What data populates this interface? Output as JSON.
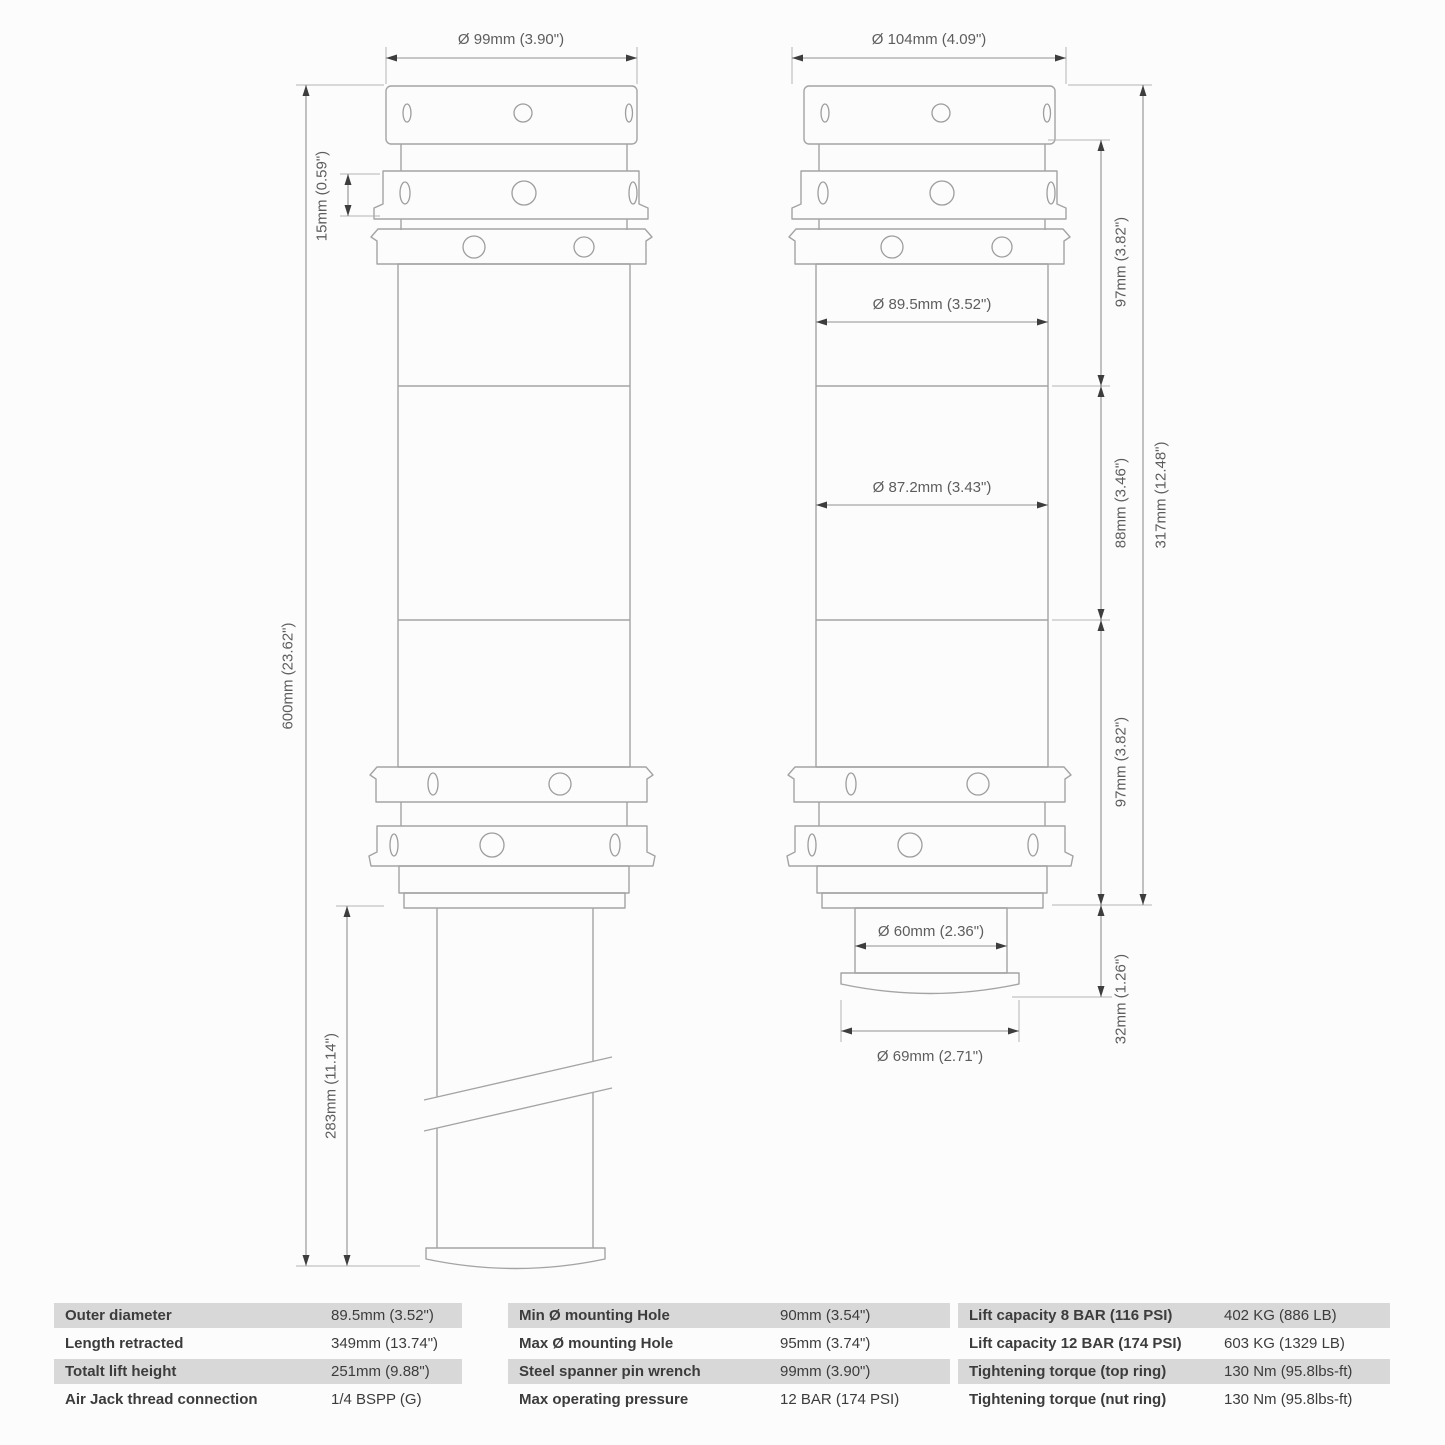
{
  "drawing": {
    "extended_view": {
      "outer_diameter": "Ø  99mm (3.90\")",
      "nut_ring_height": "15mm (0.59\")",
      "total_length": "600mm (23.62\")",
      "piston_extension": "283mm (11.14\")"
    },
    "retracted_view": {
      "top_diameter": "Ø  104mm (4.09\")",
      "upper_body_diameter": "Ø  89.5mm (3.52\")",
      "lower_body_diameter": "Ø  87.2mm (3.43\")",
      "piston_diameter": "Ø  60mm (2.36\")",
      "foot_diameter": "Ø  69mm (2.71\")",
      "upper_section_height": "97mm (3.82\")",
      "middle_section_height": "88mm (3.46\")",
      "total_body_height": "317mm (12.48\")",
      "lower_section_height": "97mm (3.82\")",
      "foot_height": "32mm (1.26\")"
    }
  },
  "spec_table": {
    "groups": [
      {
        "name": "dimensions",
        "rows": [
          {
            "label": "Outer diameter",
            "value": "89.5mm (3.52\")"
          },
          {
            "label": "Length retracted",
            "value": "349mm (13.74\")"
          },
          {
            "label": "Totalt lift height",
            "value": "251mm (9.88\")"
          },
          {
            "label": "Air Jack thread connection",
            "value": "1/4 BSPP (G)"
          }
        ]
      },
      {
        "name": "mounting",
        "rows": [
          {
            "label": "Min Ø mounting Hole",
            "value": "90mm (3.54\")"
          },
          {
            "label": "Max Ø mounting Hole",
            "value": "95mm (3.74\")"
          },
          {
            "label": "Steel spanner pin wrench",
            "value": "99mm (3.90\")"
          },
          {
            "label": "Max operating pressure",
            "value": "12 BAR (174 PSI)"
          }
        ]
      },
      {
        "name": "capacity",
        "rows": [
          {
            "label": "Lift capacity 8 BAR (116 PSI)",
            "value": "402 KG (886 LB)"
          },
          {
            "label": "Lift capacity 12 BAR (174 PSI)",
            "value": "603 KG (1329 LB)"
          },
          {
            "label": "Tightening torque (top ring)",
            "value": "130 Nm (95.8lbs-ft)"
          },
          {
            "label": "Tightening torque (nut ring)",
            "value": "130 Nm (95.8lbs-ft)"
          }
        ]
      }
    ]
  }
}
